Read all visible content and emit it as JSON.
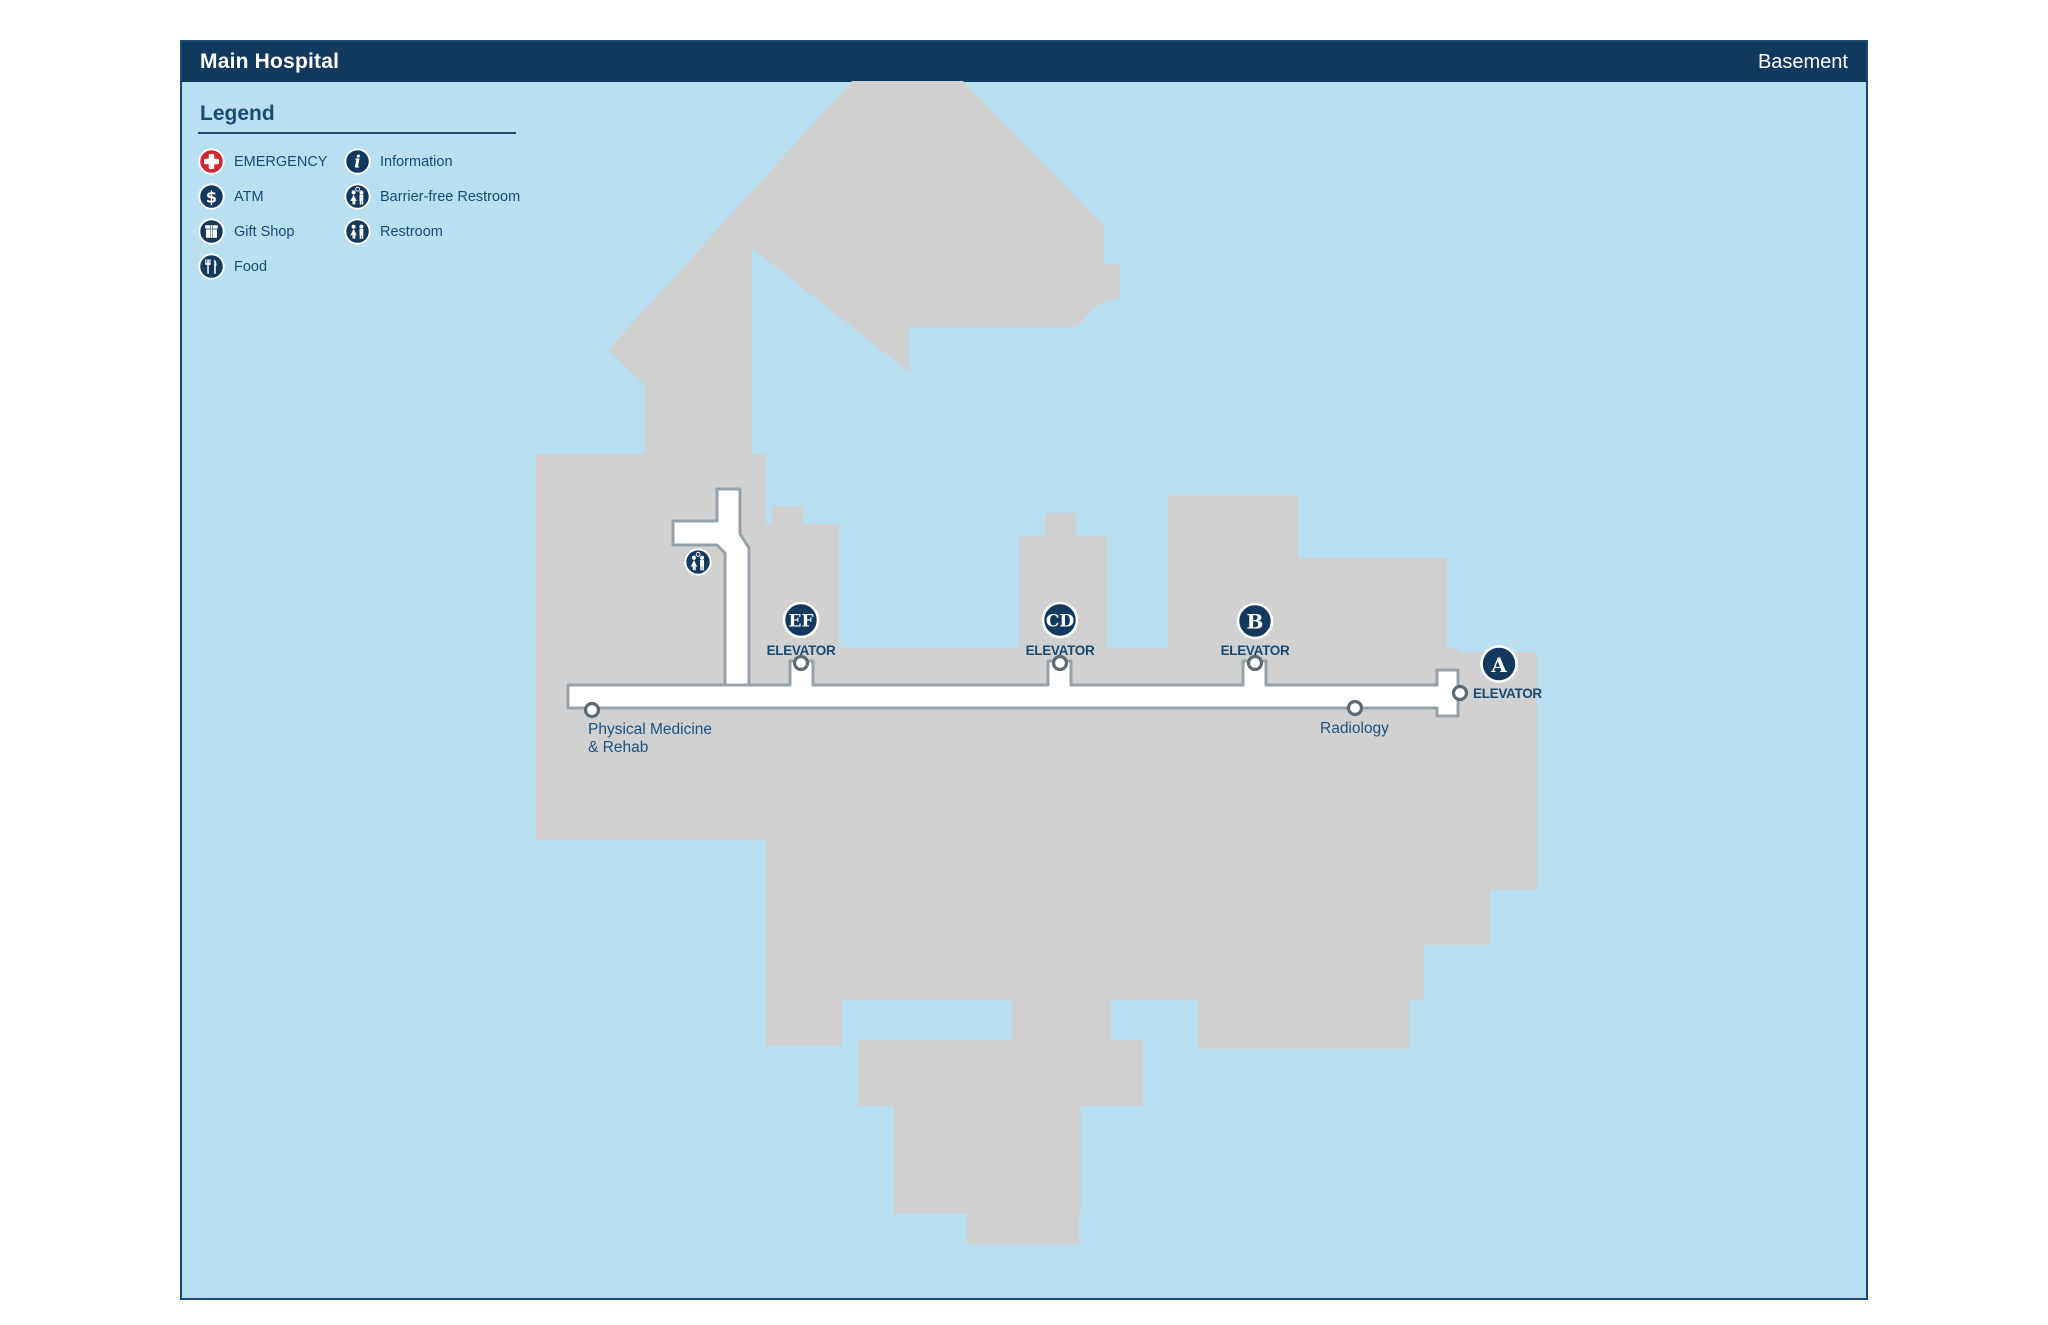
{
  "header": {
    "title": "Main Hospital",
    "floor": "Basement"
  },
  "legend": {
    "title": "Legend",
    "items": [
      {
        "label": "EMERGENCY",
        "icon": "emergency-cross-icon"
      },
      {
        "label": "ATM",
        "icon": "dollar-icon"
      },
      {
        "label": "Gift Shop",
        "icon": "gift-icon"
      },
      {
        "label": "Food",
        "icon": "fork-knife-icon"
      },
      {
        "label": "Information",
        "icon": "info-icon"
      },
      {
        "label": "Barrier-free Restroom",
        "icon": "barrier-free-restroom-icon"
      },
      {
        "label": "Restroom",
        "icon": "restroom-icon"
      }
    ]
  },
  "map": {
    "elevators": [
      {
        "id": "EF",
        "label": "ELEVATOR"
      },
      {
        "id": "CD",
        "label": "ELEVATOR"
      },
      {
        "id": "B",
        "label": "ELEVATOR"
      },
      {
        "id": "A",
        "label": "ELEVATOR"
      }
    ],
    "rooms": {
      "physical_medicine_line1": "Physical Medicine",
      "physical_medicine_line2": "& Rehab",
      "radiology": "Radiology"
    },
    "map_icons": [
      {
        "name": "barrier-free-restroom"
      }
    ]
  },
  "colors": {
    "header_navy": "#123a5f",
    "map_background": "#b9dff3",
    "building_gray": "#d1d1d2",
    "corridor_fill": "#ffffff",
    "corridor_stroke": "#97a1a8",
    "marker_navy": "#14395e",
    "emergency_red": "#d22630",
    "text_navy": "#174a73"
  }
}
